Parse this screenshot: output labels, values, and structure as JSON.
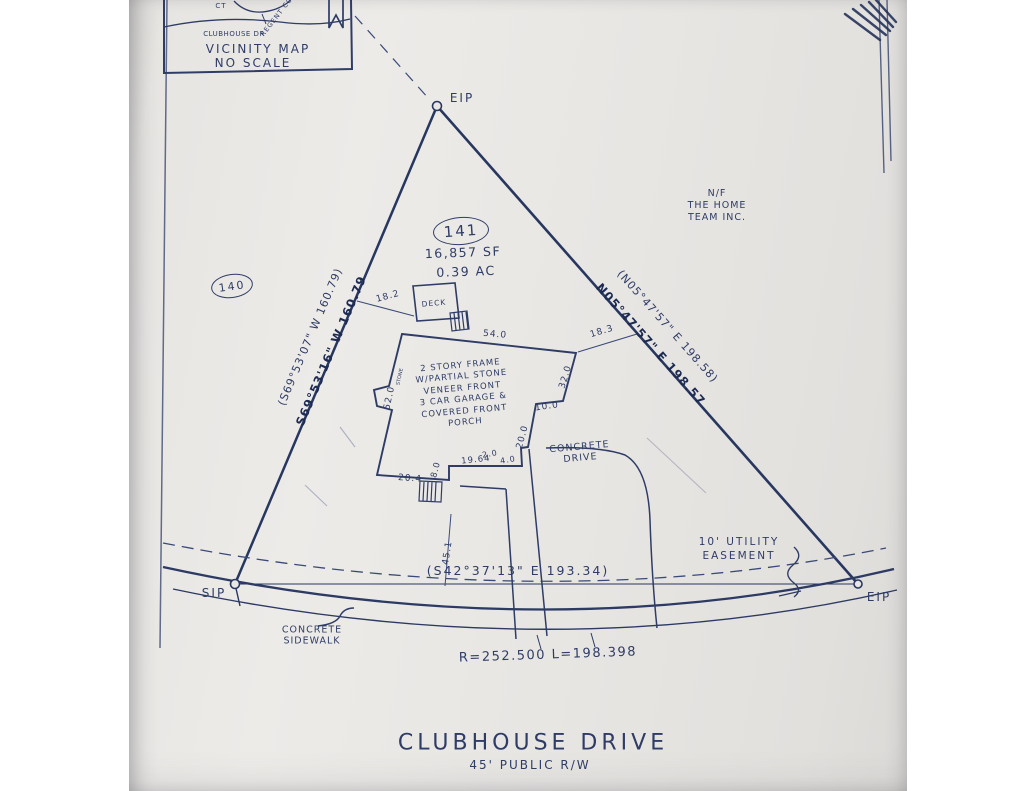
{
  "vicinity": {
    "title": "VICINITY MAP",
    "scale": "NO SCALE",
    "road_ct": "CT",
    "road_court": "REGENT COURT",
    "road_clubhouse": "CLUBHOUSE DR"
  },
  "markers": {
    "eip_top": "EIP",
    "sip": "SIP",
    "eip_right": "EIP"
  },
  "lot": {
    "number": "141",
    "area_sf": "16,857 SF",
    "area_ac": "0.39 AC",
    "adjacent_lot": "140",
    "adjoiner": "N/F\nTHE HOME\nTEAM INC."
  },
  "bearings": {
    "west_record": "(S69°53'07\" W 160.79)",
    "west_measured": "S69°53'16\" W 160.79",
    "east_record": "(N05°47'57\" E 198.58)",
    "east_measured": "N05°47'57\" E 198.57",
    "chord": "(S42°37'13\" E 193.34)",
    "curve": "R=252.500 L=198.398"
  },
  "house": {
    "description": "2 STORY FRAME\nW/PARTIAL STONE\nVENEER FRONT\n3 CAR GARAGE &\nCOVERED FRONT\nPORCH",
    "deck": "DECK",
    "stone_note": "STONE"
  },
  "dimensions": {
    "deck_offset": "18.2",
    "front_width": "54.0",
    "side_offset": "18.3",
    "right_upper": "32.0",
    "right_jog": "10.0",
    "porch_side": "20.0",
    "left_depth": "52.0",
    "garage_width": "20.4",
    "porch_step": "8.0",
    "step_a": "2.0",
    "step_b": "4.0",
    "porch_front": "19.64",
    "walk_length": "45.1"
  },
  "site": {
    "drive": "CONCRETE\nDRIVE",
    "sidewalk": "CONCRETE\nSIDEWALK",
    "easement": "10' UTILITY\nEASEMENT"
  },
  "street": {
    "name": "CLUBHOUSE DRIVE",
    "right_of_way": "45' PUBLIC R/W"
  }
}
